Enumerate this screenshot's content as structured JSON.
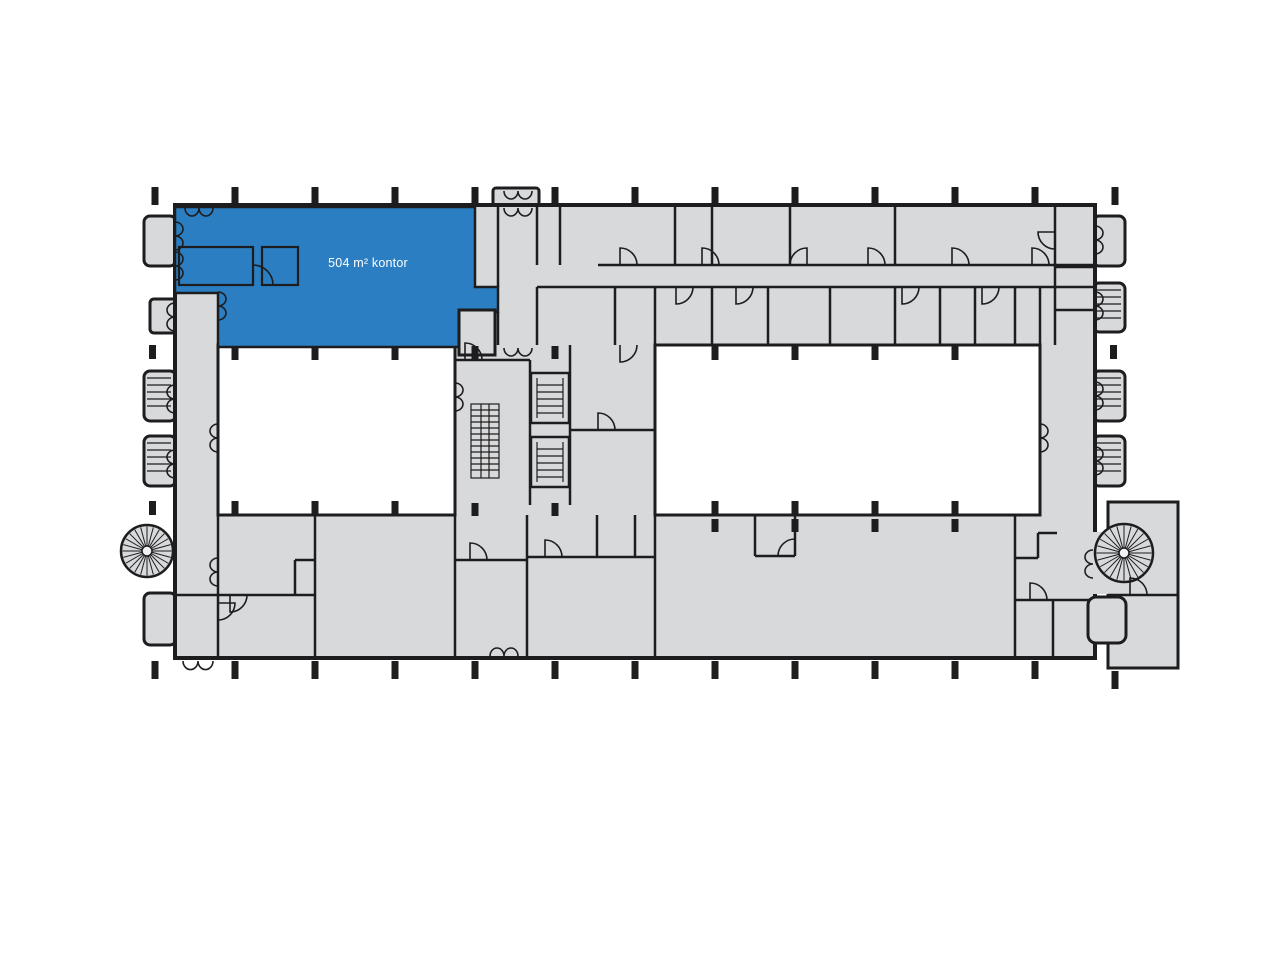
{
  "document": {
    "kind": "building-floor-plan"
  },
  "highlight": {
    "label": "504 m² kontor"
  },
  "colors": {
    "background": "#ffffff",
    "floor": "#d8d9da",
    "wall": "#1d1d1f",
    "highlight": "#2b7ec1",
    "highlight_text": "#ffffff",
    "courtyard": "#ffffff"
  },
  "icons": {
    "spiral_staircases": [
      {
        "name": "spiral-staircase-icon",
        "cx": 147,
        "cy": 551,
        "r": 26
      },
      {
        "name": "spiral-staircase-icon",
        "cx": 1124,
        "cy": 553,
        "r": 29
      }
    ],
    "straight_stairs": {
      "name": "straight-stairs-icon"
    },
    "elevators": [
      {
        "name": "elevator-icon"
      },
      {
        "name": "elevator-icon"
      }
    ]
  },
  "grid": {
    "top_ticks_x": [
      155,
      235,
      315,
      395,
      475,
      555,
      635,
      715,
      795,
      875,
      955,
      1035,
      1115
    ],
    "bottom_ticks_x": [
      155,
      235,
      315,
      395,
      475,
      555,
      635,
      715,
      795,
      875,
      955,
      1035
    ],
    "ext_bottom_ticks_x": [
      1115
    ],
    "left_ticks_y": [
      352,
      508
    ],
    "right_ticks_y": [
      352
    ],
    "courtyard_left_ticks_x": [
      235,
      315,
      395
    ],
    "courtyard_right_ticks_x": [
      715,
      795,
      875,
      955
    ],
    "core_ticks_x": [
      475,
      555
    ],
    "bottom_room_ticks_x": [
      715,
      795,
      875,
      955
    ]
  }
}
